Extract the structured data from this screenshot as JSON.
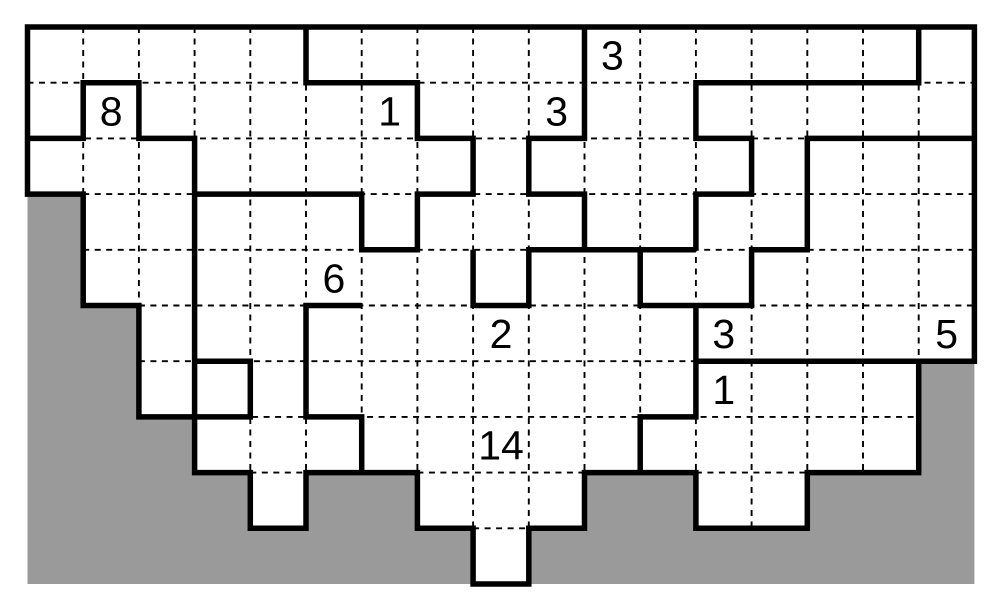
{
  "puzzle": {
    "description": "irregular staircase-shaped logic puzzle grid with shaded outside area, dashed cell lines, thick region walls and numeric clues",
    "grid": {
      "cols": 17,
      "rows": 10,
      "cell_size": 55.7,
      "origin_x": 27.5,
      "origin_y": 27
    },
    "colors": {
      "background": "#ffffff",
      "outside_fill": "#9a9a9a",
      "wall": "#000000",
      "dash": "#000000",
      "clue_text": "#000000"
    },
    "style": {
      "wall_width": 5.5,
      "dash_width": 1.9,
      "dash_on": 6,
      "dash_off": 5.5,
      "clue_font_size": 41
    },
    "column_last_white_row": [
      2,
      4,
      6,
      7,
      8,
      7,
      7,
      8,
      9,
      8,
      7,
      7,
      8,
      8,
      7,
      7,
      5
    ],
    "outer_boundary": [
      [
        0,
        0
      ],
      [
        17,
        0
      ],
      [
        17,
        6
      ],
      [
        16,
        6
      ],
      [
        16,
        8
      ],
      [
        14,
        8
      ],
      [
        14,
        9
      ],
      [
        12,
        9
      ],
      [
        12,
        8
      ],
      [
        10,
        8
      ],
      [
        10,
        9
      ],
      [
        9,
        9
      ],
      [
        9,
        10
      ],
      [
        8,
        10
      ],
      [
        8,
        9
      ],
      [
        7,
        9
      ],
      [
        7,
        8
      ],
      [
        5,
        8
      ],
      [
        5,
        9
      ],
      [
        4,
        9
      ],
      [
        4,
        8
      ],
      [
        3,
        8
      ],
      [
        3,
        7
      ],
      [
        2,
        7
      ],
      [
        2,
        5
      ],
      [
        1,
        5
      ],
      [
        1,
        3
      ],
      [
        0,
        3
      ]
    ],
    "interior_walls": [
      [
        [
          5,
          0
        ],
        [
          5,
          1
        ],
        [
          7,
          1
        ],
        [
          7,
          2
        ],
        [
          8,
          2
        ],
        [
          8,
          3
        ],
        [
          7,
          3
        ],
        [
          7,
          4
        ],
        [
          6,
          4
        ],
        [
          6,
          3
        ],
        [
          3,
          3
        ]
      ],
      [
        [
          3,
          7
        ],
        [
          3,
          2
        ],
        [
          2,
          2
        ],
        [
          2,
          1
        ],
        [
          1,
          1
        ],
        [
          1,
          2
        ],
        [
          0,
          2
        ]
      ],
      [
        [
          3,
          6
        ],
        [
          4,
          6
        ],
        [
          4,
          7
        ],
        [
          3,
          7
        ]
      ],
      [
        [
          6,
          5
        ],
        [
          5,
          5
        ],
        [
          5,
          7
        ],
        [
          6,
          7
        ],
        [
          6,
          8
        ]
      ],
      [
        [
          8,
          4
        ],
        [
          8,
          5
        ],
        [
          9,
          5
        ],
        [
          9,
          4
        ],
        [
          12,
          4
        ]
      ],
      [
        [
          11,
          4
        ],
        [
          11,
          5
        ],
        [
          13,
          5
        ],
        [
          13,
          4
        ],
        [
          14,
          4
        ],
        [
          14,
          2
        ],
        [
          17,
          2
        ]
      ],
      [
        [
          10,
          0
        ],
        [
          10,
          2
        ],
        [
          9,
          2
        ],
        [
          9,
          3
        ],
        [
          10,
          3
        ],
        [
          10,
          4
        ]
      ],
      [
        [
          16,
          0
        ],
        [
          16,
          1
        ],
        [
          12,
          1
        ],
        [
          12,
          2
        ],
        [
          13,
          2
        ],
        [
          13,
          3
        ],
        [
          12,
          3
        ],
        [
          12,
          4
        ]
      ],
      [
        [
          12,
          5
        ],
        [
          12,
          7
        ],
        [
          11,
          7
        ],
        [
          11,
          8
        ]
      ],
      [
        [
          12,
          6
        ],
        [
          16,
          6
        ]
      ]
    ],
    "clues": [
      {
        "value": "8",
        "col": 1,
        "row": 1
      },
      {
        "value": "1",
        "col": 6,
        "row": 1
      },
      {
        "value": "3",
        "col": 10,
        "row": 0
      },
      {
        "value": "3",
        "col": 9,
        "row": 1
      },
      {
        "value": "6",
        "col": 5,
        "row": 4
      },
      {
        "value": "2",
        "col": 8,
        "row": 5
      },
      {
        "value": "3",
        "col": 12,
        "row": 5
      },
      {
        "value": "5",
        "col": 16,
        "row": 5
      },
      {
        "value": "1",
        "col": 12,
        "row": 6
      },
      {
        "value": "14",
        "col": 8,
        "row": 7
      }
    ]
  }
}
